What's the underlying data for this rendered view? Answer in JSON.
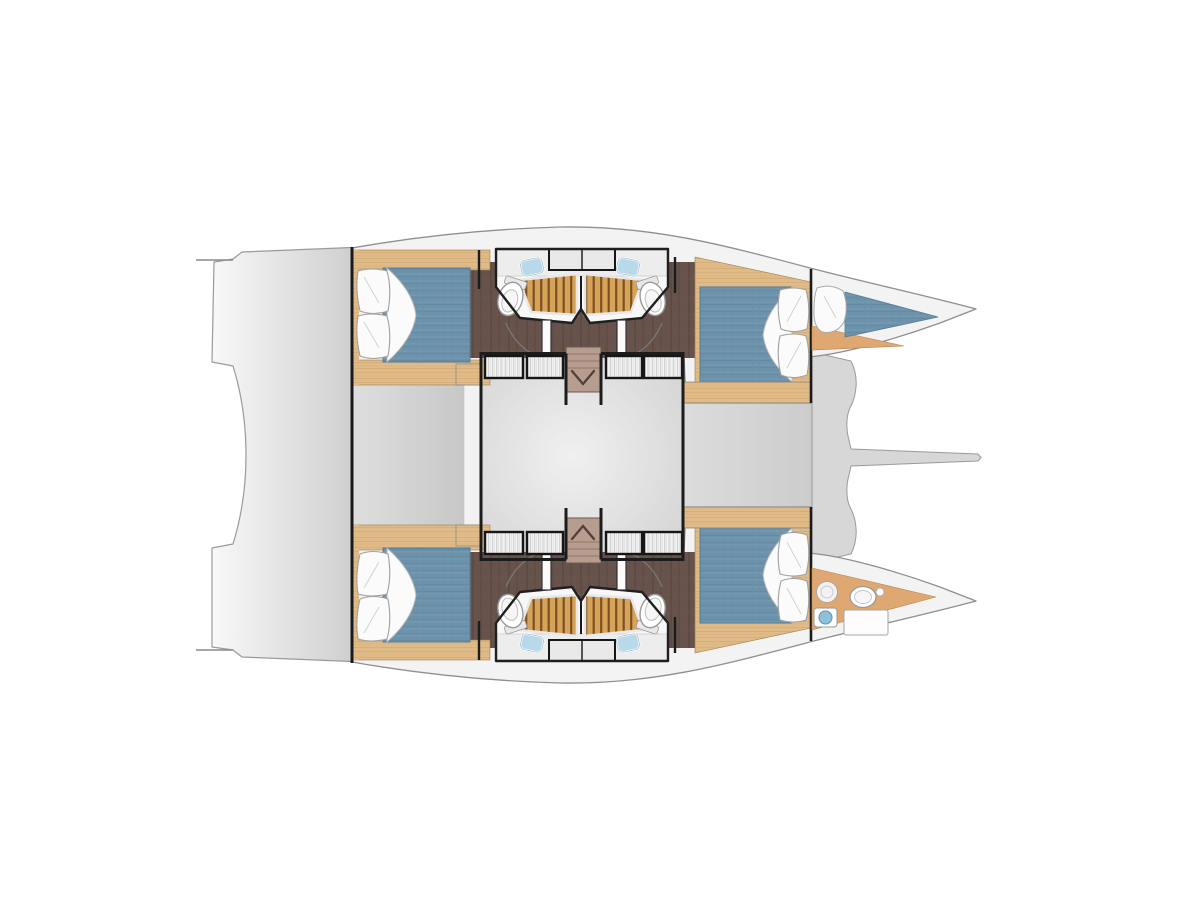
{
  "diagram": {
    "type": "floor-plan",
    "subject": "catamaran yacht lower-deck cabin layout",
    "view": "top-down",
    "orientation": {
      "bow": "right",
      "stern": "left",
      "top_hull": "port",
      "bottom_hull": "starboard"
    },
    "canvas": {
      "width": 1200,
      "height": 900,
      "background": "#ffffff"
    }
  },
  "labels": {
    "plan": "Catamaran lower deck floor plan, bow to the right",
    "aft_deck": "Aft deck and transom steps",
    "saloon": "Central saloon / bridgedeck area",
    "port_hull": "Port hull (top)",
    "starboard_hull": "Starboard hull (bottom)",
    "aft_cabin": "Aft double cabin with blue mattress and two pillows",
    "forward_cabin": "Forward double cabin with blue mattress and two pillows",
    "heads": "Twin bathrooms with teak shower gratings, toilets and washbasins",
    "wardrobes": "Hatched wardrobe lockers flanking companionway",
    "stairs": "Companionway stairs with direction arrow",
    "forepeak_berth": "Port forepeak skipper berth",
    "crew_head": "Starboard forepeak crew head with toilet and washbasin",
    "foredeck": "Forward crossbeam with central longitudinal spar and trampoline openings"
  },
  "inventory": {
    "double_cabins": 4,
    "double_beds": 4,
    "forepeak_berths": 1,
    "bathrooms": 4,
    "crew_heads": 1,
    "toilets": 5,
    "washbasins": 5,
    "shower_gratings": 4,
    "wardrobes": 8,
    "companionway_stairs": 2,
    "cabin_doors": 4,
    "mirror_cabinets": 2
  },
  "palette": {
    "background": "#ffffff",
    "hull_fill": "#f3f3f3",
    "hull_outline": "#8f8f8f",
    "deck_gray_light": "#f8f8f8",
    "deck_gray_dark": "#cfcfcf",
    "saloon_gray": "#d9d9d9",
    "wall_black": "#1c1c1c",
    "wood_light": "#e0bb88",
    "wood_grain": "#c9a066",
    "wood_dark_floor": "#67534b",
    "teak_grating": "#d7a359",
    "teak_slat": "#7c5122",
    "forepeak_floor": "#dfa873",
    "mattress_blue": "#6d92ab",
    "linen_white": "#fbfbfb",
    "fixture_white": "#fafafa",
    "basin_blue": "#8fc0da",
    "stair_taupe": "#b79d8f"
  }
}
